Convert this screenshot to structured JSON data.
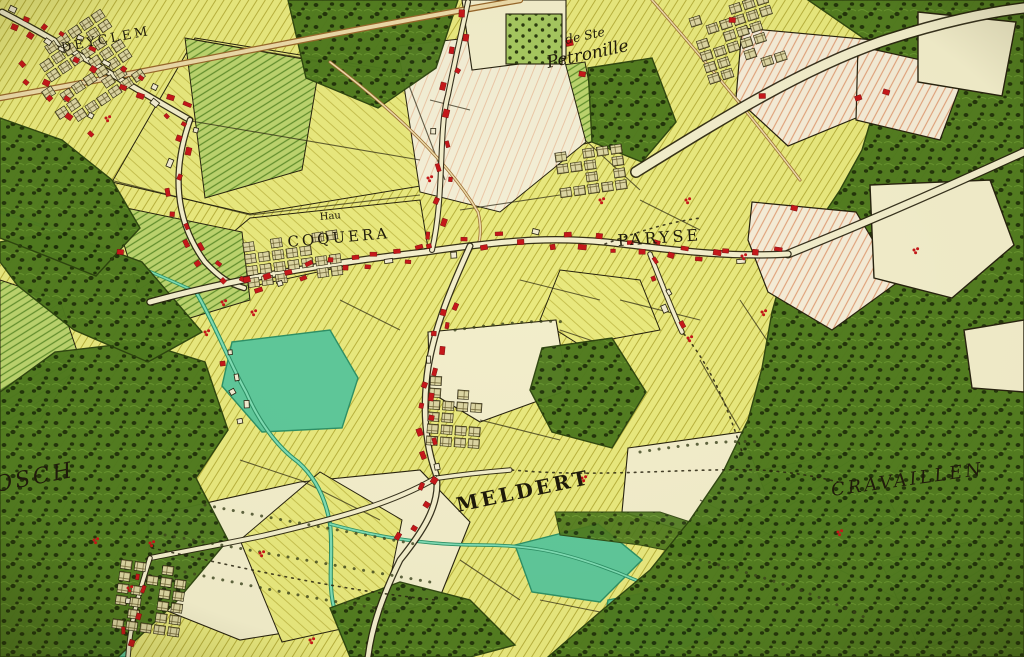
{
  "map": {
    "type": "historical-cabinet-map",
    "description": "18th-century Ferraris-style hand-coloured cadastral map with villages, fields, forests and streams",
    "labels": {
      "village_top_left": "DEYCLEM",
      "chapel_prefix": "de Ste",
      "chapel_name": "Petronille",
      "hamlet_abbreviation": "Hau",
      "hamlet_coquera": "COQUERA",
      "hamlet_paryse": "PARYSE",
      "village_meldert": "MELDERT",
      "forest_left": "OSCH",
      "forest_right": "CRAVAILLEN"
    },
    "palette": {
      "forest": "#4f7a1f",
      "forestdot": "#1e3008",
      "fieldyellow": "#e9e97e",
      "fieldline": "#b9b23e",
      "greenbase": "#bcd46e",
      "greenline": "#63902e",
      "cream": "#f3eecb",
      "teal": "#5fc89a",
      "tealdark": "#2e9066",
      "housered": "#c6181a",
      "roadbrown": "#98682c",
      "pinkline": "#e2a47c",
      "ink": "#27220f"
    }
  }
}
